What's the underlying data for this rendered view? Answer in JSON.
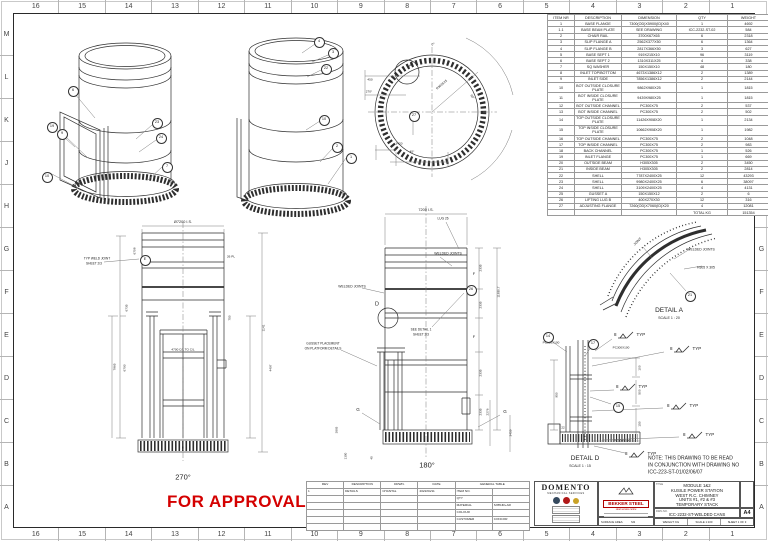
{
  "grid": {
    "cols": [
      "16",
      "15",
      "14",
      "13",
      "12",
      "11",
      "10",
      "9",
      "8",
      "7",
      "6",
      "5",
      "4",
      "3",
      "2",
      "1"
    ],
    "rows": [
      "M",
      "L",
      "K",
      "J",
      "H",
      "G",
      "F",
      "E",
      "D",
      "C",
      "B",
      "A"
    ]
  },
  "bom": {
    "headers": [
      "ITEM NR",
      "DESCRIPTION",
      "DIMENSION",
      "QTY",
      "WEIGHT"
    ],
    "rows": [
      [
        "1",
        "BASE FLANGE",
        "7300(OD)X5900(ID)X40",
        "1",
        "4692"
      ],
      [
        "1.1",
        "BASE BEAM PLATE",
        "SEE DRAWING",
        "ICC-2232-ST-02",
        "584"
      ],
      [
        "2",
        "CHAIR RAIL",
        "3700X67X65",
        "6",
        "2318"
      ],
      [
        "3",
        "SLIP FLANGE A",
        "2562X377X50",
        "6",
        "1364"
      ],
      [
        "4",
        "SLIP FLANGE B",
        "2817X366X50",
        "3",
        "627"
      ],
      [
        "5",
        "BASE SEPT 1",
        "919X215X10",
        "96",
        "3119"
      ],
      [
        "6",
        "BASE SEPT 2",
        "1310X311X25",
        "4",
        "338"
      ],
      [
        "7",
        "SQ WASHER",
        "150X150X10",
        "48",
        "180"
      ],
      [
        "8",
        "INLET TOP/BOTTOM",
        "4673X1386X12",
        "2",
        "1389"
      ],
      [
        "9",
        "INLET SIDE",
        "7856X1386X12",
        "2",
        "2144"
      ],
      [
        "10",
        "BOT OUTSIDE CLOSURE PLATE",
        "9862X980X25",
        "1",
        "1815"
      ],
      [
        "11",
        "BOT INSIDE CLOSURE PLATE",
        "9439X980X25",
        "1",
        "1815"
      ],
      [
        "12",
        "BOT OUTSIDE CHANNEL",
        "PC300X75",
        "2",
        "537"
      ],
      [
        "13",
        "BOT INSIDE CHANNEL",
        "PC300X75",
        "2",
        "502"
      ],
      [
        "14",
        "TOP OUTSIDE CLOSURE PLATE",
        "11426X908X20",
        "1",
        "2134"
      ],
      [
        "15",
        "TOP INSIDE CLOSURE PLATE",
        "10662X908X20",
        "1",
        "1982"
      ],
      [
        "16",
        "TOP OUTSIDE CHANNEL",
        "PC300X75",
        "2",
        "1048"
      ],
      [
        "17",
        "TOP INSIDE CHANNEL",
        "PC300X75",
        "2",
        "983"
      ],
      [
        "18",
        "BACK CHANNEL",
        "PC300X75",
        "1",
        "526"
      ],
      [
        "19",
        "INLET FLANGE",
        "PC300X75",
        "1",
        "669"
      ],
      [
        "20",
        "OUTSIDE BEAM",
        "H305X305",
        "2",
        "3450"
      ],
      [
        "21",
        "INSIDE BEAM",
        "H305X305",
        "2",
        "2814"
      ],
      [
        "22",
        "SHELL",
        "7787X2400X25",
        "12",
        "43293"
      ],
      [
        "23",
        "SHELL",
        "9980X2400X25",
        "6",
        "38097"
      ],
      [
        "24",
        "SHELL",
        "3109X2400X25",
        "4",
        "4131"
      ],
      [
        "25",
        "GUSSET A",
        "150X150X12",
        "2",
        "6"
      ],
      [
        "26",
        "LIFTING LUG B",
        "400X270X30",
        "12",
        "316"
      ],
      [
        "27",
        "ADJUSTING FLANGE",
        "7260(OD)X7060(ID)X20",
        "4",
        "12081"
      ]
    ],
    "total_label": "TOTAL KG",
    "total_value": "151354"
  },
  "stamp": {
    "text": "FOR APPROVAL",
    "color": "#d40000"
  },
  "titleblock": {
    "company": "DOMENTO",
    "company_sub": "MECHANICAL SERVICES",
    "fabricator": "BEKKER STEEL",
    "fabricator_sub": "steel service centre",
    "title_label": "TITLE",
    "title_lines": [
      "MODULE 1&2",
      "KUSILE POWER STATION",
      "WEST R.C. CHIMNEY",
      "UNITS #1, #2 & #3",
      "TEMPORARY STACK"
    ],
    "dwg_label": "DWG NO.",
    "dwg_no": "ICC-2232-ST-WELDED CANS",
    "paper": "A4",
    "weight_label": "WEIGHT: KG",
    "scale_label": "SCALE 1:100",
    "sheet_label": "SHEET 1 OF 3",
    "surface_label": "SURFACE AREA:",
    "surface_unit": "M2"
  },
  "revision": {
    "headers": [
      "REV",
      "DESCRIPTION",
      "DRWN.",
      "DATE"
    ],
    "row": [
      "1",
      "DETAILS",
      "CHANTAL",
      "2022/04/11"
    ],
    "general_title": "GENERAL TABLE",
    "general_rows": [
      [
        "ITEM NO.",
        ""
      ],
      [
        "QTY",
        ""
      ],
      [
        "MATERIAL",
        "S355JR+AR"
      ],
      [
        "COLOUR",
        ""
      ],
      [
        "CUSTOMER",
        "CONCOR"
      ]
    ]
  },
  "weld": {
    "num": "8",
    "typ": "TYP",
    "flags": [
      [
        614,
        336
      ],
      [
        670,
        350
      ],
      [
        616,
        388
      ],
      [
        667,
        407
      ],
      [
        683,
        436
      ],
      [
        625,
        455
      ]
    ]
  },
  "balloons": [
    [
      "6",
      72,
      90
    ],
    [
      "19",
      51,
      126
    ],
    [
      "9",
      61,
      133
    ],
    [
      "10",
      46,
      176
    ],
    [
      "23",
      156,
      122
    ],
    [
      "24",
      160,
      137
    ],
    [
      "7",
      166,
      166
    ],
    [
      "4",
      318,
      41
    ],
    [
      "3",
      332,
      52
    ],
    [
      "22",
      325,
      68
    ],
    [
      "10",
      323,
      119
    ],
    [
      "2",
      336,
      146
    ],
    [
      "1",
      350,
      157
    ],
    [
      "27",
      413,
      115
    ],
    [
      "21",
      689,
      295
    ],
    [
      "14",
      547,
      336
    ],
    [
      "17",
      592,
      343
    ],
    [
      "15",
      617,
      406
    ],
    [
      "E",
      144,
      259
    ],
    [
      "26",
      470,
      289
    ]
  ],
  "labels": [
    {
      "t": "270°",
      "x": 183,
      "y": 477,
      "fs": 7.5,
      "n": "view-label-270"
    },
    {
      "t": "180°",
      "x": 427,
      "y": 465,
      "fs": 7.5,
      "n": "view-label-180"
    },
    {
      "t": "DETAIL A",
      "x": 669,
      "y": 311,
      "fs": 6.5,
      "n": "detail-a-label"
    },
    {
      "t": "SCALE 1 : 20",
      "x": 669,
      "y": 319,
      "fs": 3.6
    },
    {
      "t": "DETAIL D",
      "x": 585,
      "y": 459,
      "fs": 6.5,
      "n": "detail-d-label"
    },
    {
      "t": "SCALE 1 : 15",
      "x": 580,
      "y": 467,
      "fs": 3.6
    },
    {
      "t": "NOTE: THIS DRAWING TO BE READ",
      "x": 648,
      "y": 459,
      "fs": 5,
      "a": "l",
      "n": "note-line"
    },
    {
      "t": "IN CONJUNCTION WITH DRAWING NO",
      "x": 648,
      "y": 466,
      "fs": 5,
      "a": "l",
      "n": "note-line"
    },
    {
      "t": "ICC-223-ST-01/02/06/07",
      "x": 648,
      "y": 473,
      "fs": 5,
      "a": "l",
      "n": "note-line"
    },
    {
      "t": "Ø7200 I.S.",
      "x": 183,
      "y": 223,
      "fs": 3.8
    },
    {
      "t": "7200 I.S.",
      "x": 426,
      "y": 211,
      "fs": 3.8
    },
    {
      "t": "LUG 26",
      "x": 443,
      "y": 219,
      "fs": 3.2
    },
    {
      "t": "WELDED JOINTS",
      "x": 352,
      "y": 287,
      "fs": 3.4
    },
    {
      "t": "WELDED JOINTS",
      "x": 448,
      "y": 254,
      "fs": 3.4
    },
    {
      "t": "TYP WELD JOINT",
      "x": 97,
      "y": 259,
      "fs": 3.2
    },
    {
      "t": "SHEET 2/3",
      "x": 94,
      "y": 264,
      "fs": 3.2
    },
    {
      "t": "GUSSET PLACEMENT",
      "x": 323,
      "y": 344,
      "fs": 3.2
    },
    {
      "t": "ON PLATFORM DETAILS",
      "x": 323,
      "y": 349,
      "fs": 3.2
    },
    {
      "t": "SEE DETAIL 1",
      "x": 421,
      "y": 330,
      "fs": 3.2
    },
    {
      "t": "SHEET 2/3",
      "x": 421,
      "y": 335,
      "fs": 3.2
    },
    {
      "t": "WELDED JOINTS",
      "x": 701,
      "y": 250,
      "fs": 3.4
    },
    {
      "t": "H305 X 305",
      "x": 706,
      "y": 268,
      "fs": 3.4
    },
    {
      "t": "JOINT",
      "x": 638,
      "y": 242,
      "fs": 3.4,
      "r": -45
    },
    {
      "t": "PC300X100",
      "x": 551,
      "y": 343,
      "fs": 3.1
    },
    {
      "t": "PC300X100",
      "x": 621,
      "y": 348,
      "fs": 3.1
    },
    {
      "t": "PC300X100",
      "x": 622,
      "y": 441,
      "fs": 3.1
    },
    {
      "t": "100",
      "x": 640,
      "y": 368,
      "fs": 3.1,
      "r": -90
    },
    {
      "t": "500",
      "x": 640,
      "y": 392,
      "fs": 3.1,
      "r": -90
    },
    {
      "t": "150",
      "x": 640,
      "y": 424,
      "fs": 3.1,
      "r": -90
    },
    {
      "t": "950",
      "x": 557,
      "y": 395,
      "fs": 3.1,
      "r": -90
    },
    {
      "t": "22",
      "x": 563,
      "y": 428,
      "fs": 3
    },
    {
      "t": "0°",
      "x": 433,
      "y": 45,
      "fs": 3.2
    },
    {
      "t": "R3639.25",
      "x": 442,
      "y": 85,
      "fs": 3.1,
      "r": -40
    },
    {
      "t": "90°",
      "x": 472,
      "y": 97,
      "fs": 3.1,
      "r": 55
    },
    {
      "t": "450",
      "x": 370,
      "y": 80,
      "fs": 3.1
    },
    {
      "t": "270°",
      "x": 369,
      "y": 92,
      "fs": 3.1
    },
    {
      "t": "3420",
      "x": 399,
      "y": 144,
      "fs": 3.1
    },
    {
      "t": "45°",
      "x": 412,
      "y": 152,
      "fs": 3.1
    },
    {
      "t": "A",
      "x": 411,
      "y": 66,
      "fs": 5.5,
      "n": "detail-a-callout"
    },
    {
      "t": "6708",
      "x": 135,
      "y": 251,
      "fs": 3.1,
      "r": -90
    },
    {
      "t": "6735",
      "x": 127,
      "y": 308,
      "fs": 3.1,
      "r": -90
    },
    {
      "t": "7865",
      "x": 115,
      "y": 367,
      "fs": 3.1,
      "r": -90
    },
    {
      "t": "6793",
      "x": 125,
      "y": 368,
      "fs": 3.1,
      "r": -90
    },
    {
      "t": "1141",
      "x": 264,
      "y": 328,
      "fs": 3.1,
      "r": -90
    },
    {
      "t": "4497",
      "x": 271,
      "y": 368,
      "fs": 3.1,
      "r": -90
    },
    {
      "t": "750",
      "x": 230,
      "y": 318,
      "fs": 3.1,
      "r": -90
    },
    {
      "t": "4700 C/L TO C/L",
      "x": 183,
      "y": 350,
      "fs": 3.1
    },
    {
      "t": "26 PL",
      "x": 231,
      "y": 257,
      "fs": 3.1
    },
    {
      "t": "2335",
      "x": 481,
      "y": 268,
      "fs": 3.1,
      "r": -90
    },
    {
      "t": "2335",
      "x": 481,
      "y": 305,
      "fs": 3.1,
      "r": -90
    },
    {
      "t": "2335",
      "x": 481,
      "y": 373,
      "fs": 3.1,
      "r": -90
    },
    {
      "t": "2335",
      "x": 481,
      "y": 412,
      "fs": 3.1,
      "r": -90
    },
    {
      "t": "11830.7",
      "x": 499,
      "y": 292,
      "fs": 3.1,
      "r": -90
    },
    {
      "t": "2276",
      "x": 488,
      "y": 412,
      "fs": 3.1,
      "r": -90
    },
    {
      "t": "3459",
      "x": 511,
      "y": 433,
      "fs": 3.1,
      "r": -90
    },
    {
      "t": "1300",
      "x": 346,
      "y": 456,
      "fs": 3,
      "r": -90
    },
    {
      "t": "40",
      "x": 372,
      "y": 458,
      "fs": 3,
      "r": -90
    },
    {
      "t": "3865",
      "x": 337,
      "y": 430,
      "fs": 3,
      "r": -90
    },
    {
      "t": "D",
      "x": 377,
      "y": 305,
      "fs": 5.5,
      "n": "detail-d-callout"
    },
    {
      "t": "G",
      "x": 358,
      "y": 410,
      "fs": 4.5
    },
    {
      "t": "G",
      "x": 505,
      "y": 412,
      "fs": 4.5
    },
    {
      "t": "F",
      "x": 474,
      "y": 274,
      "fs": 4
    },
    {
      "t": "F",
      "x": 474,
      "y": 337,
      "fs": 4
    }
  ]
}
